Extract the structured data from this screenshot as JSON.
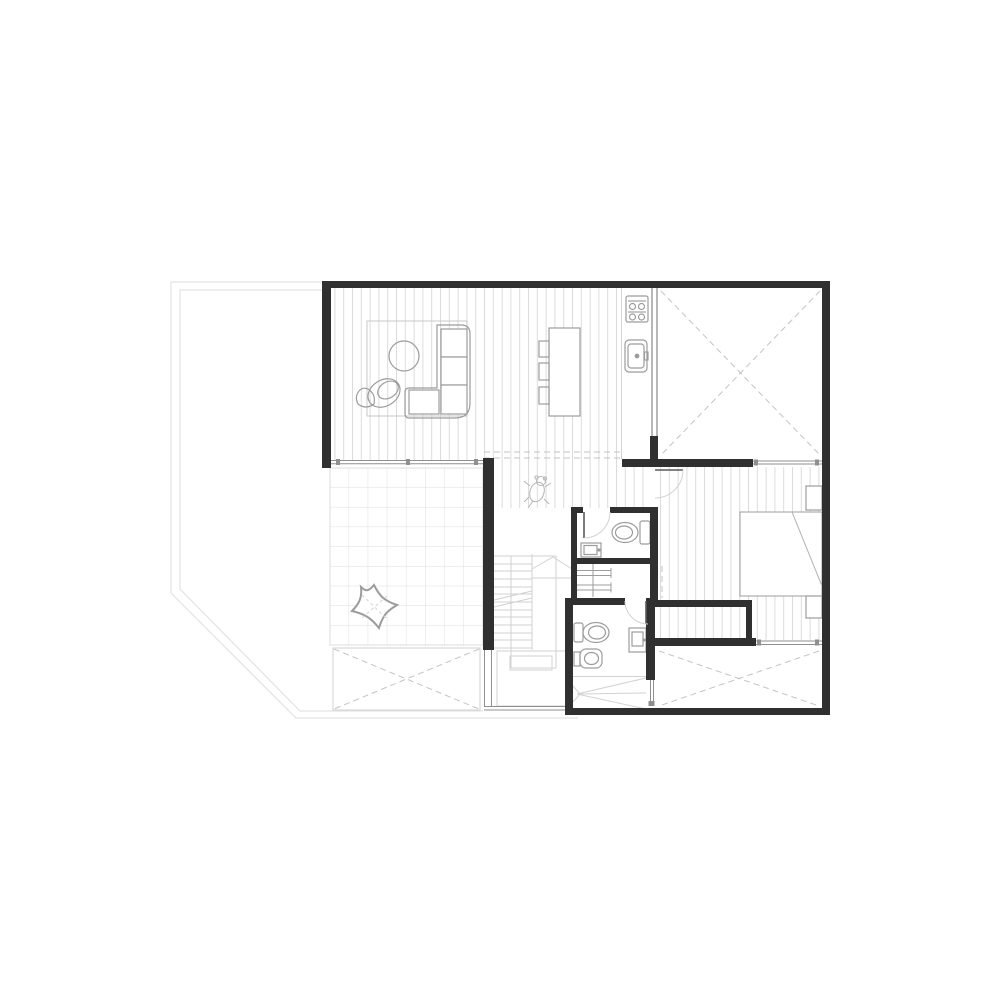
{
  "document": {
    "type": "architectural-floor-plan",
    "visible_text": [],
    "notes": "line drawing only, no text labels rendered in pixels"
  },
  "colors": {
    "background": "#ffffff",
    "wall": "#303030",
    "stud": "#6f6f6f",
    "medium": "#8f8f8f",
    "furn": "#9c9c9c",
    "light": "#d2d2d2",
    "hatch": "#dcdcdc",
    "tile": "#dedede",
    "boundary": "#e3e3e3",
    "dash": "#c3c3c3",
    "faint": "#b5b5b5"
  },
  "plan": {
    "rooms": [
      "living-area",
      "dining-area",
      "kitchen",
      "garage-void-room",
      "hallway",
      "stair-core",
      "upper-bathroom",
      "linen-closet",
      "lower-bathroom",
      "bedroom",
      "wardrobe-strip",
      "tiled-terrace",
      "deck-bottom-left",
      "deck-bottom-right",
      "property-yard"
    ],
    "fixtures": [
      "l-shaped-sofa",
      "round-coffee-table",
      "lounge-chair",
      "area-rug",
      "dining-table",
      "dining-chairs",
      "cooktop",
      "kitchen-sink",
      "toilet",
      "washbasin",
      "bidet",
      "vanity-sink",
      "shower",
      "shelving",
      "double-bed",
      "nightstands",
      "star-pouf",
      "dog-figure",
      "stairs",
      "door-swings",
      "window-bands",
      "dashed-cross-markers"
    ]
  }
}
